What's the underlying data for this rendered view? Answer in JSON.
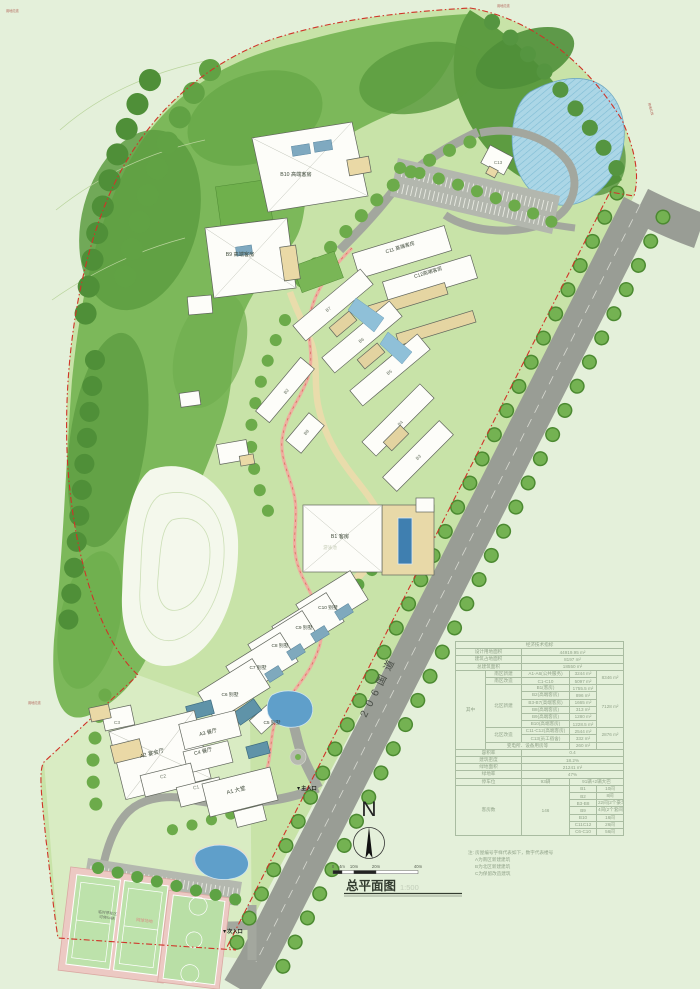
{
  "titleblock": {
    "title": "总平面图",
    "scale": "1:500"
  },
  "north": {
    "letter": "N"
  },
  "scalebar": {
    "l0": "0",
    "l1": "4m",
    "l2": "10m",
    "l3": "20m",
    "l4": "40m"
  },
  "road": {
    "label": "206国道"
  },
  "entrances": {
    "main": "▼主入口",
    "secondary": "▼次入口"
  },
  "boundary": {
    "annotation": "用地红线"
  },
  "site_labels": {
    "temp_parking_1": "临时停车区",
    "temp_parking_2": "可停54辆",
    "tennis": "网球场地",
    "pool": "游泳池"
  },
  "buildings": [
    {
      "label": "B10 高端客房"
    },
    {
      "label": "B9 高端客房"
    },
    {
      "label": "C11 高端客房"
    },
    {
      "label": "C12高端客房"
    },
    {
      "label": "C13"
    },
    {
      "label": "B7"
    },
    {
      "label": "B6"
    },
    {
      "label": "B5"
    },
    {
      "label": "B4"
    },
    {
      "label": "B3"
    },
    {
      "label": "B2"
    },
    {
      "label": "B8"
    },
    {
      "label": "B1 客房"
    },
    {
      "label": "C10 别墅"
    },
    {
      "label": "C9 别墅"
    },
    {
      "label": "C8 别墅"
    },
    {
      "label": "C7 别墅"
    },
    {
      "label": "C6 别墅"
    },
    {
      "label": "C5 别墅"
    },
    {
      "label": "A1 大堂"
    },
    {
      "label": "A2 宴会厅"
    },
    {
      "label": "A3 餐厅"
    },
    {
      "label": "C4 餐厅"
    },
    {
      "label": "C1"
    },
    {
      "label": "C2"
    },
    {
      "label": "C3"
    }
  ],
  "indicators": {
    "title": "经济技术指标",
    "site_area_label": "设计用地面积",
    "site_area_value": "44919.95 m²",
    "footprint_label": "建筑占地面积",
    "footprint_value": "8197 m²",
    "gfa_label": "总建筑面积",
    "gfa_value": "18550 m²",
    "among_label": "其中",
    "south_new_label": "南区新建",
    "south_new_name": "A1-A6(公共服务)",
    "south_new_value": "3244 m²",
    "south_renov_label": "南区改造",
    "south_renov_name": "C1-C10",
    "south_renov_value": "5097 m²",
    "south_total": "8346 m²",
    "north_new_label": "北区新建",
    "north_rows": [
      {
        "name": "B1(客房)",
        "value": "1755.5 m²"
      },
      {
        "name": "B2(高端客房)",
        "value": "896 m²"
      },
      {
        "name": "B3-B7(高端客房)",
        "value": "1665 m²"
      },
      {
        "name": "B8(高端客房)",
        "value": "313 m²"
      },
      {
        "name": "B9(高端客房)",
        "value": "1280 m²"
      },
      {
        "name": "B10(高端客房)",
        "value": "1228.5 m²"
      }
    ],
    "north_total": "7128 m²",
    "north_renov_label": "北区改造",
    "north_renov_rows": [
      {
        "name": "C11-C12(高端客房)",
        "value": "2544 m²"
      },
      {
        "name": "C13(员工宿舍)",
        "value": "332 m²"
      }
    ],
    "north_renov_total": "2876 m²",
    "utility_label": "变电所、设备用房等",
    "utility_value": "260 m²",
    "far_label": "容积率",
    "far_value": "0.4",
    "density_label": "建筑密度",
    "density_value": "18.2%",
    "green_area_label": "绿地面积",
    "green_area_value": "21241 m²",
    "green_rate_label": "绿地率",
    "green_rate_value": "47%",
    "parking_label": "停车位",
    "parking_value": "93辆",
    "parking_note": "91辆+2辆大巴",
    "rooms_label": "客房数",
    "rooms_total": "146",
    "room_rows": [
      {
        "name": "B1",
        "value": "10间"
      },
      {
        "name": "B2",
        "value": "8间"
      },
      {
        "name": "B3-B8",
        "value": "22间(2个豪华套间)"
      },
      {
        "name": "B9",
        "value": "4间(2个套间)"
      },
      {
        "name": "B10",
        "value": "16间"
      },
      {
        "name": "C11C12",
        "value": "26间"
      },
      {
        "name": "C6-C10",
        "value": "56间"
      }
    ]
  },
  "note": {
    "line1": "注: 房屋编号字样代表如下，数字代表楼号",
    "line2": "A为南区新建建筑",
    "line3": "B为北区新建建筑",
    "line4": "C为保留改造建筑"
  }
}
